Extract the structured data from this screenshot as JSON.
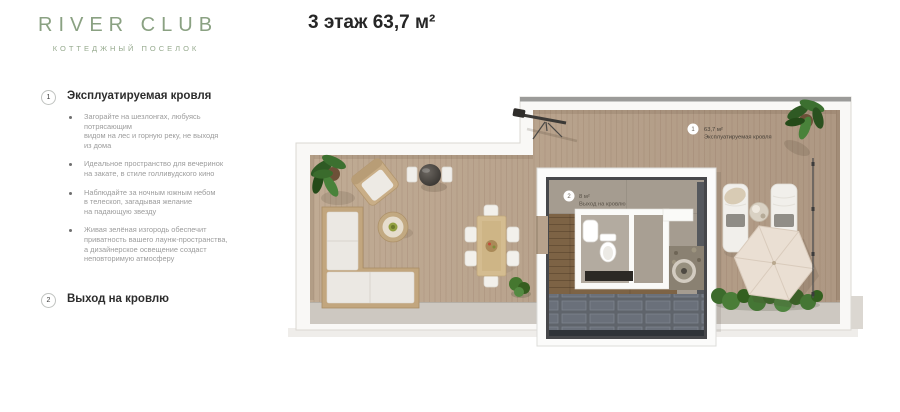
{
  "brand": {
    "name": "RIVER CLUB",
    "tagline": "КОТТЕДЖНЫЙ ПОСЕЛОК"
  },
  "page_title": "3 этаж 63,7 м²",
  "legend": {
    "items": [
      {
        "number": "1",
        "title": "Эксплуатируемая кровля",
        "bullets": [
          "Загорайте на шезлонгах, любуясь\nпотрясающим\nвидом на лес и горную реку, не выходя\nиз дома",
          "Идеальное пространство для вечеринок\nна закате, в стиле голливудского кино",
          "Наблюдайте за ночным южным небом\nв телескоп, загадывая желание\nна падающую звезду",
          "Живая зелёная изгородь обеспечит\nприватность вашего лаунж-пространства,\nа дизайнерское освещение создаст\nнеповторимую атмосферу"
        ]
      },
      {
        "number": "2",
        "title": "Выход на кровлю",
        "bullets": []
      }
    ]
  },
  "plan": {
    "labels": [
      {
        "number": "1",
        "area": "63,7 м²",
        "name": "Эксплуатируемая кровля"
      },
      {
        "number": "2",
        "area": "8 м²",
        "name": "Выход на кровлю"
      }
    ]
  },
  "colors": {
    "brand_green": "#8aa182",
    "deck_tan": "#b7a28c",
    "text_dark": "#262626",
    "text_muted": "#9c9c9c",
    "label_circle": "#ffffff"
  }
}
